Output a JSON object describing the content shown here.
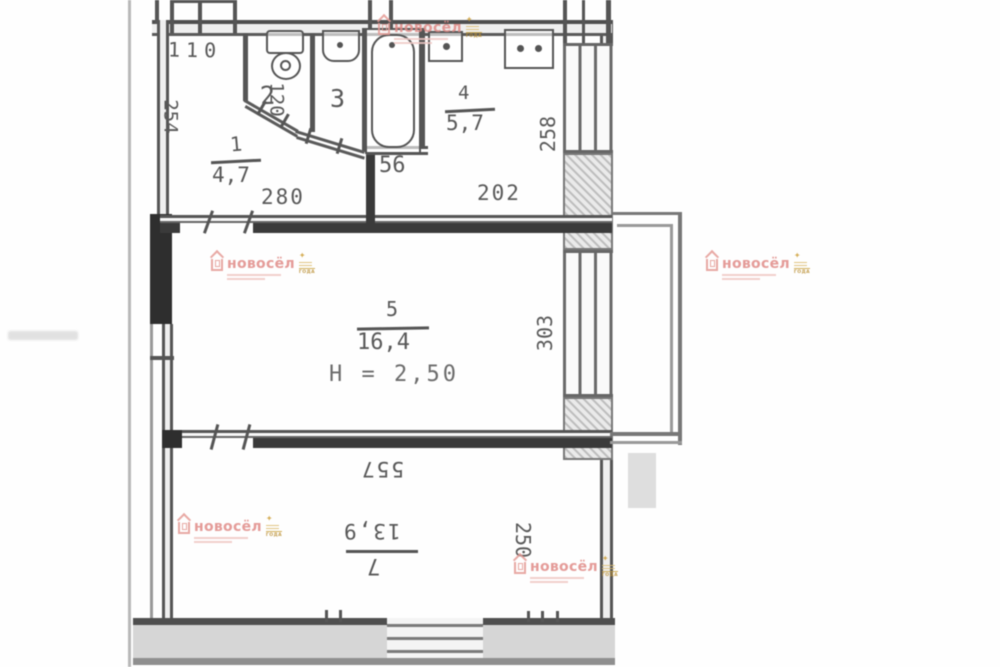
{
  "plan": {
    "rooms": {
      "r1": {
        "number": "1",
        "area": "4,7"
      },
      "r2": {
        "number": "2"
      },
      "r3": {
        "number": "3"
      },
      "r4": {
        "number": "4",
        "area": "5,7"
      },
      "r5": {
        "number": "5",
        "area": "16,4",
        "ceiling_height": "H = 2,50"
      },
      "r7": {
        "number": "7",
        "area": "13,9"
      }
    },
    "dimensions": {
      "d110": "110",
      "d254": "254",
      "d120": "120",
      "d280": "280",
      "d56": "56",
      "d202": "202",
      "d258": "258",
      "d303": "303",
      "d557": "557",
      "d250": "250"
    }
  },
  "watermark": {
    "brand": "новосёл",
    "award_line": "ГОДА",
    "brand_color": "#e08a86",
    "gold_color": "#cfa23c"
  }
}
